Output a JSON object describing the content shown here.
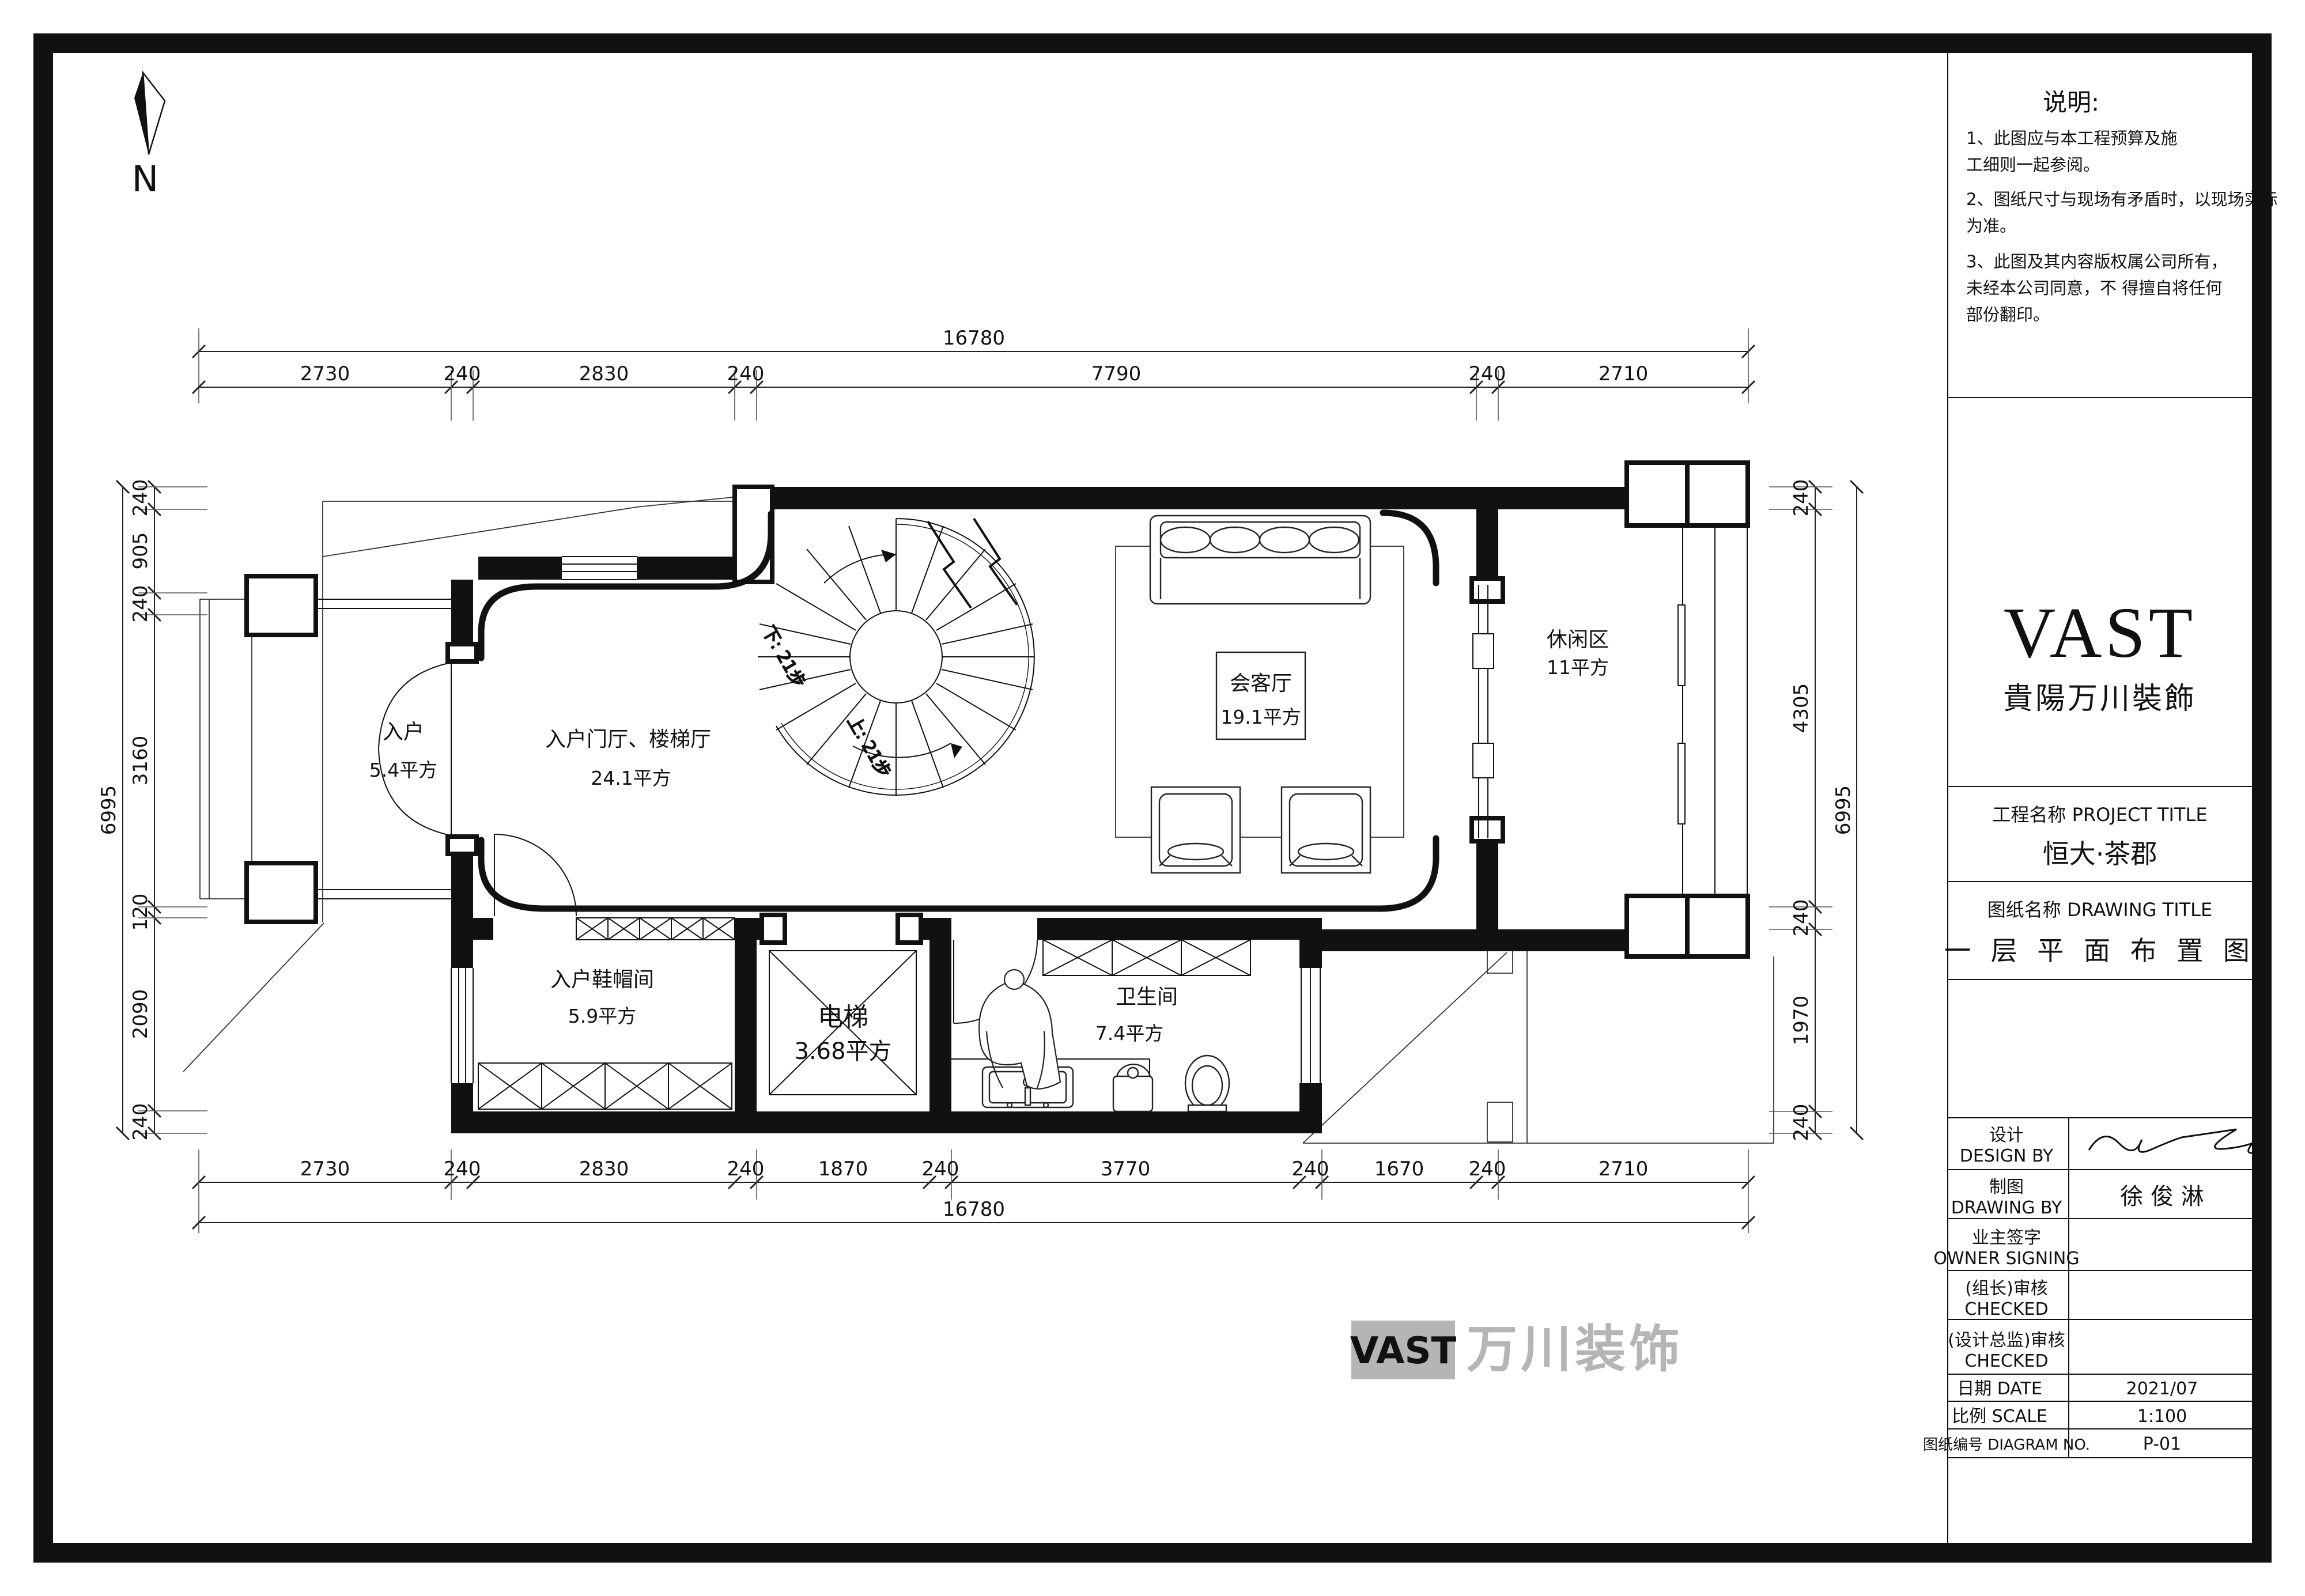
{
  "north": {
    "label": "N"
  },
  "notes": {
    "title": "说明:",
    "lines": [
      "1、此图应与本工程预算及施",
      "工细则一起参阅。",
      "2、图纸尺寸与现场有矛盾时，以现场实际",
      "为准。",
      "3、此图及其内容版权属公司所有，",
      "未经本公司同意，不  得擅自将任何",
      "部份翻印。"
    ]
  },
  "title_block": {
    "logo": "VAST",
    "company": "貴陽万川裝飾",
    "project_label": "工程名称 PROJECT TITLE",
    "project_name": "恒大·茶郡",
    "drawing_label": "图纸名称  DRAWING TITLE",
    "drawing_name": "一 层 平 面 布 置 图",
    "design_by": {
      "zh": "设计",
      "en": "DESIGN BY",
      "value": ""
    },
    "drawing_by": {
      "zh": "制图",
      "en": "DRAWING BY",
      "value": "徐 俊 淋"
    },
    "owner": {
      "zh": "业主签字",
      "en": "OWNER SIGNING",
      "value": ""
    },
    "checked1": {
      "zh": "(组长)审核",
      "en": "CHECKED",
      "value": ""
    },
    "checked2": {
      "zh": "(设计总监)审核",
      "en": "CHECKED",
      "value": ""
    },
    "date_label": "日期 DATE",
    "date_value": "2021/07",
    "scale_label": "比例 SCALE",
    "scale_value": "1:100",
    "no_label": "图纸编号  DIAGRAM NO.",
    "no_value": "P-01"
  },
  "rooms": {
    "entry": {
      "name": "入户",
      "area": "5.4平方"
    },
    "foyer": {
      "name": "入户门厅、楼梯厅",
      "area": "24.1平方"
    },
    "meeting": {
      "name": "会客厅",
      "area": "19.1平方"
    },
    "leisure": {
      "name": "休闲区",
      "area": "11平方"
    },
    "shoe": {
      "name": "入户鞋帽间",
      "area": "5.9平方"
    },
    "elevator": {
      "name": "电梯",
      "area": "3.68平方"
    },
    "bath": {
      "name": "卫生间",
      "area": "7.4平方"
    }
  },
  "stairs": {
    "down": "下: 21步",
    "up": "上: 21步"
  },
  "dims": {
    "top_total": "16780",
    "top": [
      "2730",
      "240",
      "2830",
      "240",
      "7790",
      "240",
      "2710"
    ],
    "bottom": [
      "2730",
      "240",
      "2830",
      "240",
      "1870",
      "240",
      "3770",
      "240",
      "1670",
      "240",
      "2710"
    ],
    "bottom_total": "16780",
    "left_total": "6995",
    "left": [
      "240",
      "905",
      "240",
      "3160",
      "120",
      "2090",
      "240"
    ],
    "right": [
      "240",
      "4305",
      "240",
      "1970",
      "240"
    ],
    "right_total": "6995"
  },
  "watermark": {
    "logo": "VAST",
    "brand": "万川装饰"
  }
}
